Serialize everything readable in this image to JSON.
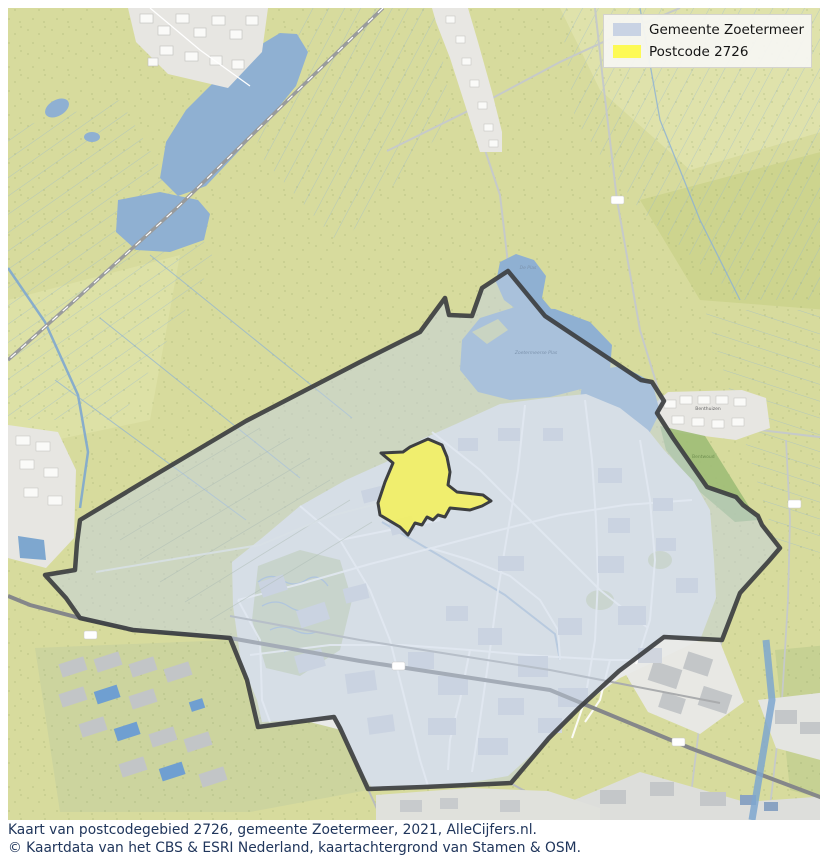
{
  "legend": {
    "items": [
      {
        "label": "Gemeente Zoetermeer",
        "color": "#c9d3e4"
      },
      {
        "label": "Postcode 2726",
        "color": "#fdfa55"
      }
    ]
  },
  "caption": {
    "line1": "Kaart van postcodegebied 2726, gemeente Zoetermeer, 2021, AlleCijfers.nl.",
    "line2": "© Kaartdata van het CBS & ESRI Nederland, kaartachtergrond van Stamen & OSM."
  },
  "map": {
    "labels": {
      "lake_small": "De Plas",
      "lake_large": "Zoetermeerse Plas",
      "village": "Benthuizen",
      "forest": "Bentwoud"
    },
    "colors": {
      "municipality_fill": "#c4d1e3",
      "municipality_outline": "#3d3f41",
      "postcode_fill": "#f3f060",
      "water": "#8fb0d2",
      "farmland": "#d7db9d",
      "urban": "#e9eae8",
      "road_major": "#85878a"
    }
  }
}
